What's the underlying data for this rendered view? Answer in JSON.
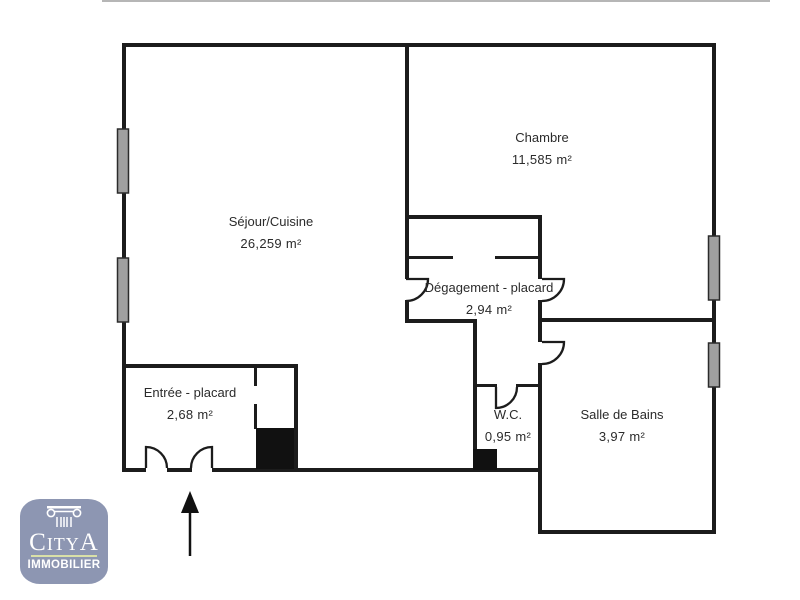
{
  "floorplan": {
    "rooms": [
      {
        "id": "sejour",
        "name": "Séjour/Cuisine",
        "area": "26,259 m²"
      },
      {
        "id": "chambre",
        "name": "Chambre",
        "area": "11,585 m²"
      },
      {
        "id": "degagement",
        "name": "Dégagement - placard",
        "area": "2,94 m²"
      },
      {
        "id": "entree",
        "name": "Entrée - placard",
        "area": "2,68 m²"
      },
      {
        "id": "wc",
        "name": "W.C.",
        "area": "0,95 m²"
      },
      {
        "id": "sdb",
        "name": "Salle de Bains",
        "area": "3,97 m²"
      }
    ],
    "colors": {
      "wall": "#1c1c1c",
      "window_fill": "#a0a0a0",
      "duct_fill": "#111111",
      "text": "#2b2b2b",
      "top_border": "#b6b6b6"
    },
    "icons": {
      "entrance_arrow": "arrow-up"
    }
  },
  "logo": {
    "brand": "CityA",
    "tagline": "IMMOBILIER",
    "badge_color": "#8d96b2",
    "divider_color": "#d9e0a8",
    "icon": "ionic-column"
  }
}
